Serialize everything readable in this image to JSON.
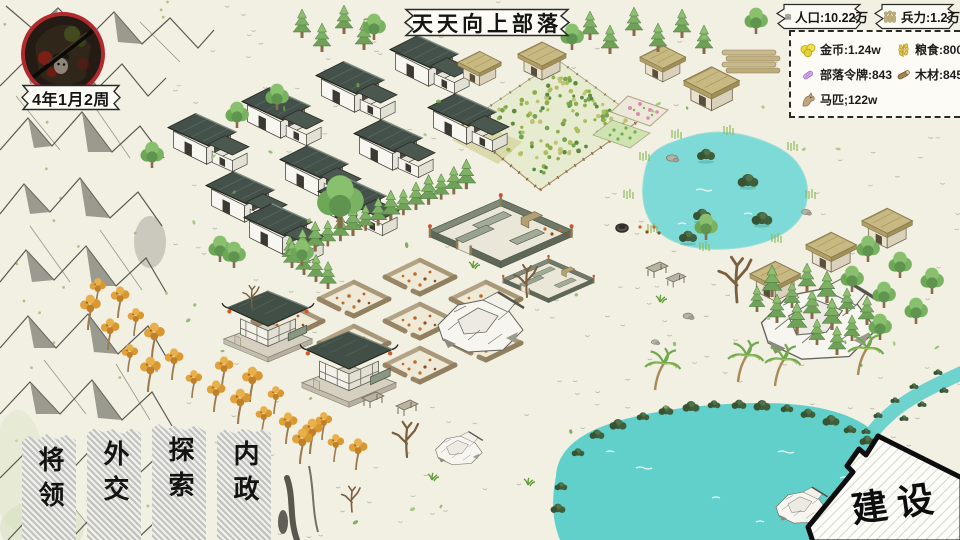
{
  "hud": {
    "title": "天天向上部落",
    "date": "4年1月2周",
    "stats": [
      {
        "icon": "population-icon",
        "label": "人口:10.22万"
      },
      {
        "icon": "troops-icon",
        "label": "兵力:1.2万"
      }
    ],
    "resources": [
      {
        "icon": "gold-icon",
        "label": "金币:1.24w"
      },
      {
        "icon": "food-icon",
        "label": "粮食:8000"
      },
      {
        "icon": "token-icon",
        "label": "部落令牌:843"
      },
      {
        "icon": "wood-icon",
        "label": "木材:845w"
      },
      {
        "icon": "horse-icon",
        "label": "马匹;122w"
      }
    ],
    "menu": [
      {
        "label": "将领"
      },
      {
        "label": "外交"
      },
      {
        "label": "探索"
      },
      {
        "label": "内政"
      }
    ],
    "build_label": "建设"
  },
  "colors": {
    "background": "#f2efe3",
    "avatar_ring": "#b3282c",
    "lake": "#62d0ca",
    "roof_slate": "#43514a",
    "hut_roof": "#c8b982",
    "hatch_grey": "#c2c2be",
    "ink": "#2b2b26"
  }
}
